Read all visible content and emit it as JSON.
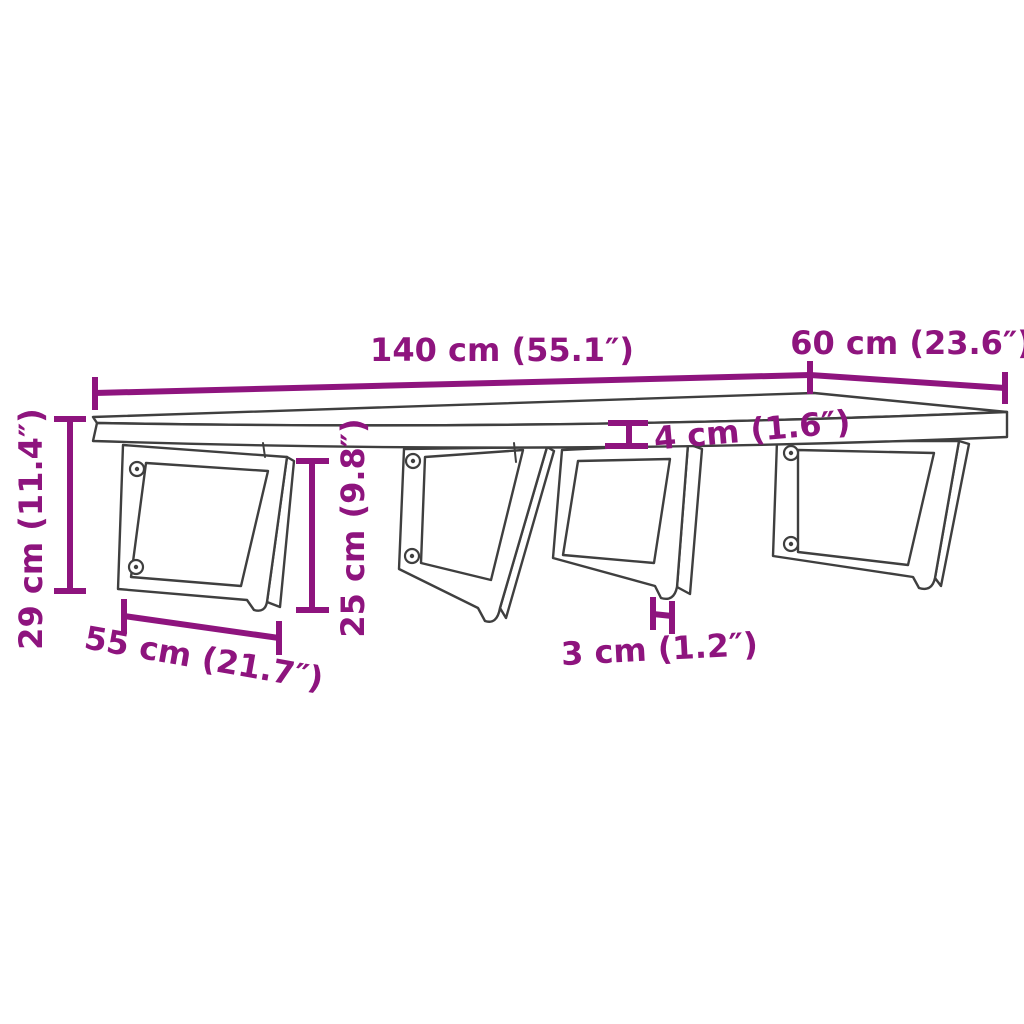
{
  "colors": {
    "accent": "#8E147E",
    "line": "#3F3F3F",
    "background": "#FFFFFF"
  },
  "diagram": {
    "type": "product-dimension-diagram",
    "subject": "wall-mounted shelf board on four trapezoid steel brackets",
    "units": [
      "cm",
      "inch"
    ]
  },
  "dimensions": {
    "width": {
      "label": "140 cm (55.1″)",
      "cm": 140,
      "inch": 55.1
    },
    "depth": {
      "label": "60 cm (23.6″)",
      "cm": 60,
      "inch": 23.6
    },
    "total_height": {
      "label": "29 cm (11.4″)",
      "cm": 29,
      "inch": 11.4
    },
    "board_thickness": {
      "label": "4 cm (1.6″)",
      "cm": 4,
      "inch": 1.6
    },
    "bracket_height": {
      "label": "25 cm (9.8″)",
      "cm": 25,
      "inch": 9.8
    },
    "bracket_depth": {
      "label": "55 cm (21.7″)",
      "cm": 55,
      "inch": 21.7
    },
    "bar_thickness": {
      "label": "3 cm (1.2″)",
      "cm": 3,
      "inch": 1.2
    }
  }
}
